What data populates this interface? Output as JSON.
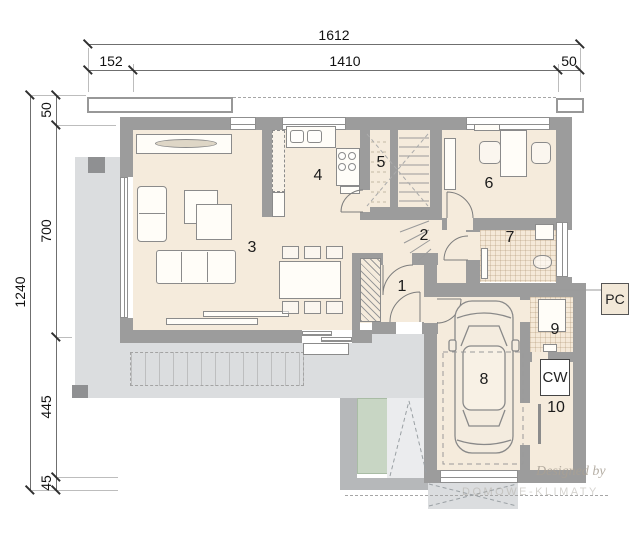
{
  "dimensions": {
    "top_total": "1612",
    "top_segments": [
      "152",
      "1410",
      "50"
    ],
    "left_total": "1240",
    "left_segments": [
      "50",
      "700",
      "445",
      "45"
    ]
  },
  "rooms": [
    "1",
    "2",
    "3",
    "4",
    "5",
    "6",
    "7",
    "8",
    "9",
    "10"
  ],
  "labels": {
    "pc": "PC",
    "cw": "CW"
  },
  "watermark": {
    "line1": "Designed by",
    "line2": "DOMOWE-KLIMATY"
  },
  "colors": {
    "wall": "#9c9c9c",
    "floor": "#f5ebdc",
    "terrace": "#dbdddf",
    "mat_green": "#c8d6c4"
  }
}
